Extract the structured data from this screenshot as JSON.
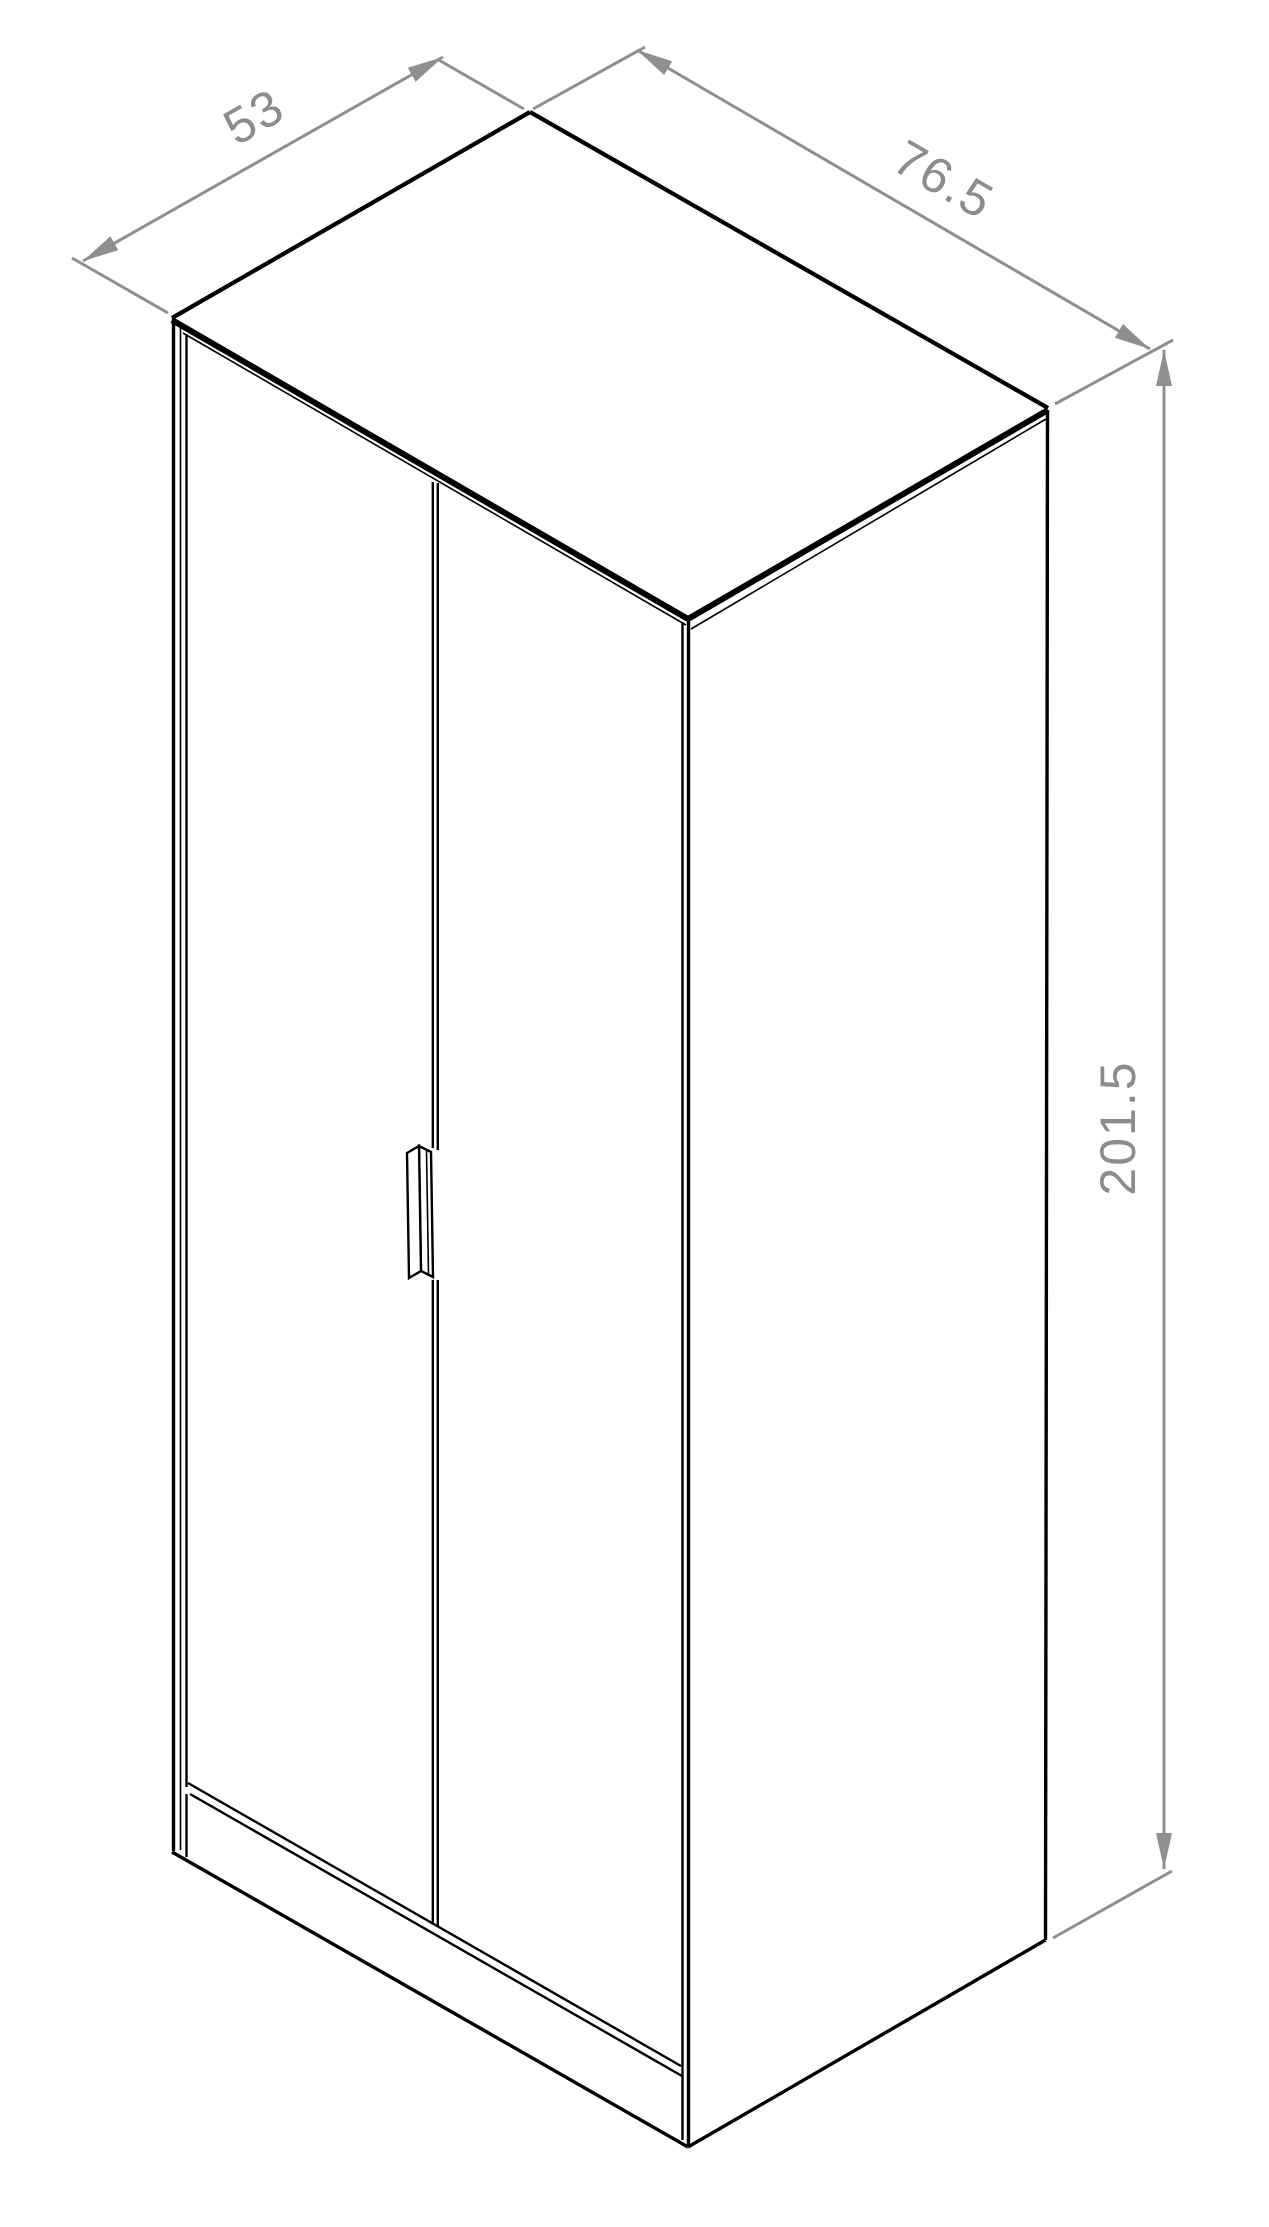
{
  "drawing": {
    "object": "two-door wardrobe",
    "view": "isometric technical drawing",
    "outline_color": "#000000",
    "dimension_line_color": "#8f8f8f",
    "label_color": "#8c8c8c",
    "background_color": "#ffffff"
  },
  "dimensions": {
    "depth": {
      "label": "53",
      "value": 53
    },
    "width": {
      "label": "76.5",
      "value": 76.5
    },
    "height": {
      "label": "201.5",
      "value": 201.5
    }
  }
}
